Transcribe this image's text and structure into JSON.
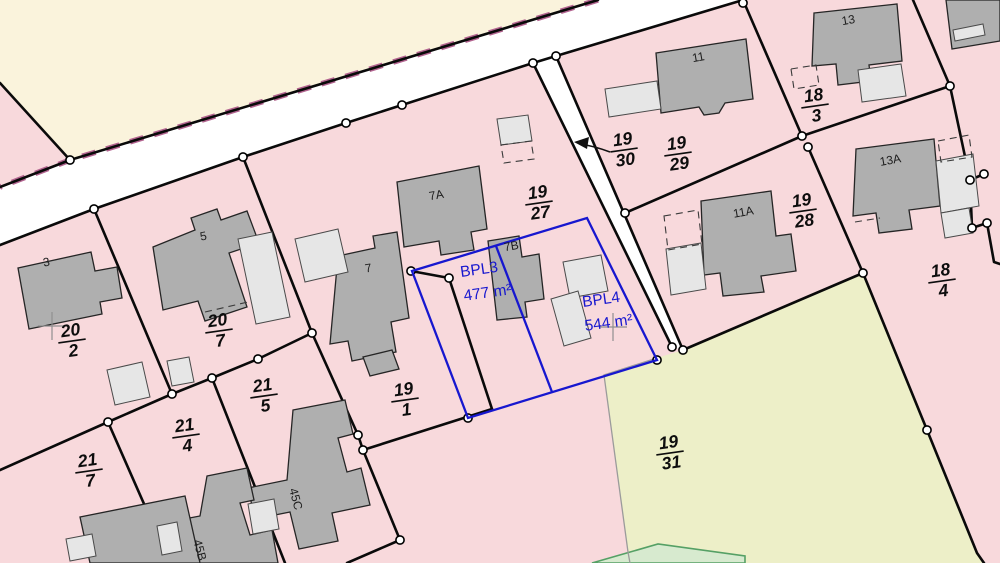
{
  "map": {
    "kind": "cadastral-parcel-map",
    "colors": {
      "parcel_pink": "#F8D9DC",
      "parcel_cream": "#FAF3DC",
      "parcel_field_green": "#EDEFC8",
      "road_white": "#FFFFFF",
      "boundary_black": "#0A0A0A",
      "building_gray": "#AFAFAF",
      "building_light_gray": "#E6E6E6",
      "plot_blue": "#1717CF",
      "road_edge_dash_purple": "#B2638F",
      "green_border": "#55A065",
      "green_fill": "#D7EACF",
      "node_fill": "#FFFFFF",
      "grid_cross": "#8F8F8F"
    },
    "parcel_labels": [
      {
        "id": "20-2",
        "num": "20",
        "den": "2"
      },
      {
        "id": "20-7",
        "num": "20",
        "den": "7"
      },
      {
        "id": "21-7",
        "num": "21",
        "den": "7"
      },
      {
        "id": "21-4",
        "num": "21",
        "den": "4"
      },
      {
        "id": "21-5",
        "num": "21",
        "den": "5"
      },
      {
        "id": "19-1",
        "num": "19",
        "den": "1"
      },
      {
        "id": "19-27",
        "num": "19",
        "den": "27"
      },
      {
        "id": "19-30",
        "num": "19",
        "den": "30"
      },
      {
        "id": "19-29",
        "num": "19",
        "den": "29"
      },
      {
        "id": "18-3",
        "num": "18",
        "den": "3"
      },
      {
        "id": "19-28",
        "num": "19",
        "den": "28"
      },
      {
        "id": "18-4",
        "num": "18",
        "den": "4"
      },
      {
        "id": "19-31",
        "num": "19",
        "den": "31"
      }
    ],
    "building_labels": [
      {
        "id": "3",
        "text": "3"
      },
      {
        "id": "5",
        "text": "5"
      },
      {
        "id": "7",
        "text": "7"
      },
      {
        "id": "7A",
        "text": "7A"
      },
      {
        "id": "7B",
        "text": "7B"
      },
      {
        "id": "11",
        "text": "11"
      },
      {
        "id": "11A",
        "text": "11A"
      },
      {
        "id": "13",
        "text": "13"
      },
      {
        "id": "13A",
        "text": "13A"
      },
      {
        "id": "45C",
        "text": "45C"
      },
      {
        "id": "45B",
        "text": "45B"
      }
    ],
    "plots": [
      {
        "id": "bpl3",
        "name": "BPL3",
        "area": "477 m²"
      },
      {
        "id": "bpl4",
        "name": "BPL4",
        "area": "544 m²"
      }
    ],
    "road_parcel_marker": {
      "points_to": "19-30"
    }
  }
}
